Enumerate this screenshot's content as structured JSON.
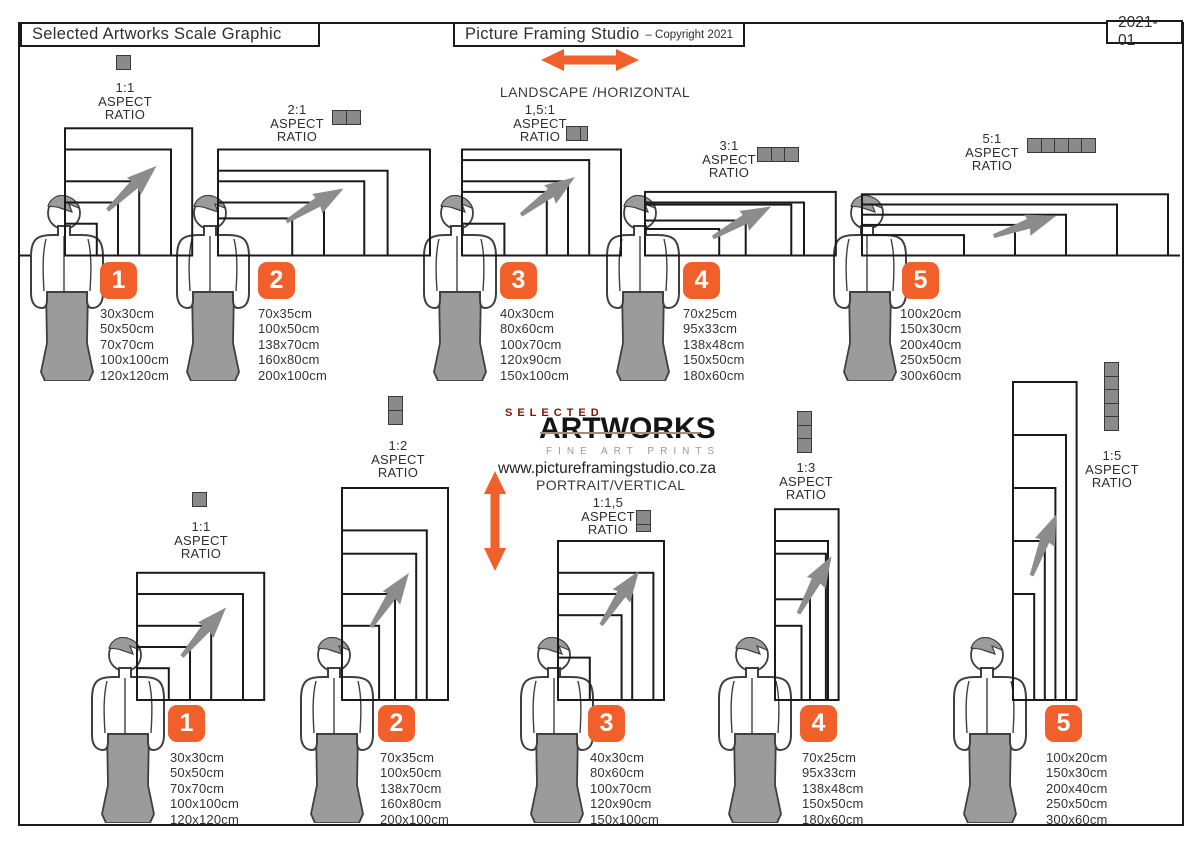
{
  "header": {
    "left_title": "Selected Artworks Scale Graphic",
    "center_title": "Picture Framing Studio",
    "center_suffix": "– Copyright 2021",
    "right_code": "2021-01"
  },
  "center": {
    "landscape_label": "LANDSCAPE /HORIZONTAL",
    "logo_top": "SELECTED",
    "logo_main": "ARTWORKS",
    "logo_sub": "FINE ART PRINTS",
    "website": "www.pictureframingstudio.co.za",
    "portrait_label": "PORTRAIT/VERTICAL"
  },
  "strings": {
    "aspect": "ASPECT",
    "ratio": "RATIO"
  },
  "colors": {
    "accent": "#F1602A",
    "frame": "#1a1a1a",
    "figure_gray": "#9b9b9b",
    "figure_stroke": "#3f3f3f",
    "icon_gray": "#8a8a8a",
    "logo_red": "#7a140c"
  },
  "landscape_groups": [
    {
      "number": "1",
      "ratio": "1:1",
      "icon_units": 1,
      "icon_orient": "h",
      "sizes": [
        "30x30cm",
        "50x50cm",
        "70x70cm",
        "100x100cm",
        "120x120cm"
      ]
    },
    {
      "number": "2",
      "ratio": "2:1",
      "icon_units": 2,
      "icon_orient": "h",
      "sizes": [
        "70x35cm",
        "100x50cm",
        "138x70cm",
        "160x80cm",
        "200x100cm"
      ]
    },
    {
      "number": "3",
      "ratio": "1,5:1",
      "icon_units": 1.5,
      "icon_orient": "h",
      "sizes": [
        "40x30cm",
        "80x60cm",
        "100x70cm",
        "120x90cm",
        "150x100cm"
      ]
    },
    {
      "number": "4",
      "ratio": "3:1",
      "icon_units": 3,
      "icon_orient": "h",
      "sizes": [
        "70x25cm",
        "95x33cm",
        "138x48cm",
        "150x50cm",
        "180x60cm"
      ]
    },
    {
      "number": "5",
      "ratio": "5:1",
      "icon_units": 5,
      "icon_orient": "h",
      "sizes": [
        "100x20cm",
        "150x30cm",
        "200x40cm",
        "250x50cm",
        "300x60cm"
      ]
    }
  ],
  "portrait_groups": [
    {
      "number": "1",
      "ratio": "1:1",
      "icon_units": 1,
      "icon_orient": "v",
      "sizes": [
        "30x30cm",
        "50x50cm",
        "70x70cm",
        "100x100cm",
        "120x120cm"
      ]
    },
    {
      "number": "2",
      "ratio": "1:2",
      "icon_units": 2,
      "icon_orient": "v",
      "sizes": [
        "70x35cm",
        "100x50cm",
        "138x70cm",
        "160x80cm",
        "200x100cm"
      ]
    },
    {
      "number": "3",
      "ratio": "1:1,5",
      "icon_units": 1.5,
      "icon_orient": "v",
      "sizes": [
        "40x30cm",
        "80x60cm",
        "100x70cm",
        "120x90cm",
        "150x100cm"
      ]
    },
    {
      "number": "4",
      "ratio": "1:3",
      "icon_units": 3,
      "icon_orient": "v",
      "sizes": [
        "70x25cm",
        "95x33cm",
        "138x48cm",
        "150x50cm",
        "180x60cm"
      ]
    },
    {
      "number": "5",
      "ratio": "1:5",
      "icon_units": 5,
      "icon_orient": "v",
      "sizes": [
        "100x20cm",
        "150x30cm",
        "200x40cm",
        "250x50cm",
        "300x60cm"
      ]
    }
  ]
}
